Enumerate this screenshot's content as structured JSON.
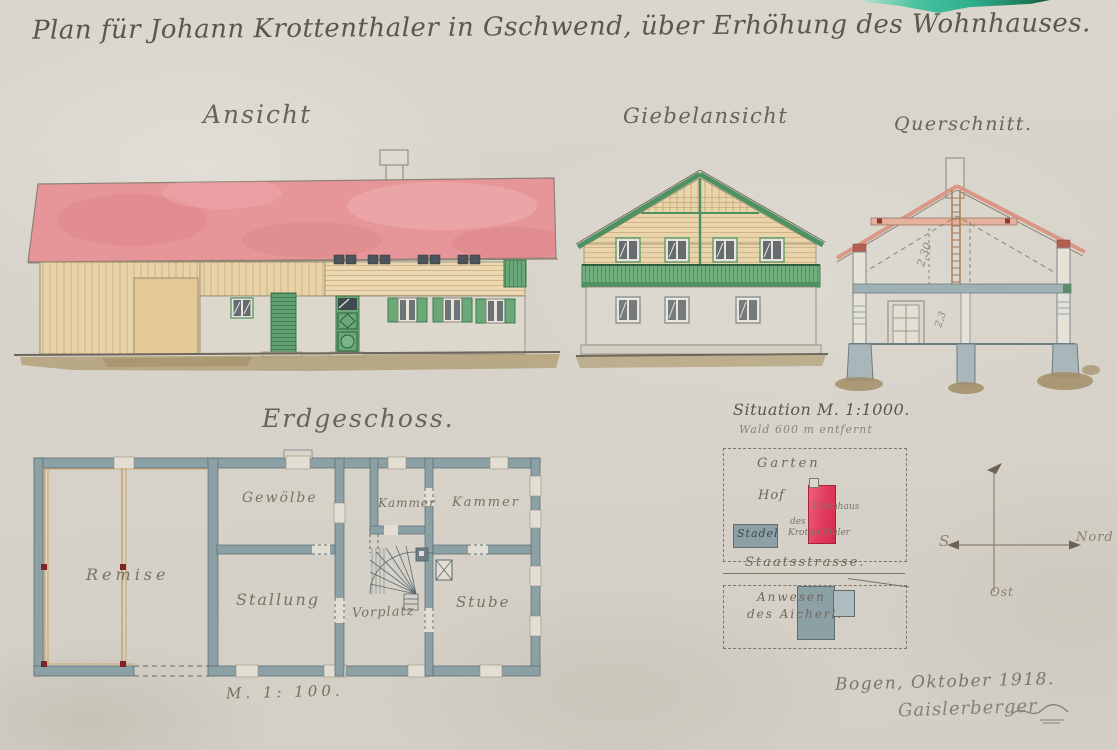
{
  "title": "Plan für Johann Krottenthaler in Gschwend, über Erhöhung des Wohnhauses.",
  "labels": {
    "ansicht": "Ansicht",
    "giebelansicht": "Giebelansicht",
    "querschnitt": "Querschnitt.",
    "erdgeschoss": "Erdgeschoss.",
    "scale_floorplan": "M. 1: 100."
  },
  "rooms": {
    "remise": "Remise",
    "gewoelbe": "Gewölbe",
    "stallung": "Stallung",
    "kammer_small": "Kammer",
    "kammer_large": "Kammer",
    "vorplatz": "Vorplatz",
    "stube": "Stube"
  },
  "cross_section": {
    "dim_upper": "2,30",
    "dim_lower": "2,3"
  },
  "situation": {
    "title": "Situation M. 1:1000.",
    "note": "Wald 600 m entfernt",
    "garten": "Garten",
    "hof": "Hof",
    "stadel": "Stadel",
    "wohnhaus": [
      "Wohnhaus",
      "des",
      "Krottenthaler"
    ],
    "strasse": "Staatsstrasse.",
    "anwesen": [
      "Anwesen",
      "des Aicherl."
    ]
  },
  "compass": {
    "sued": "S",
    "nord": "Nord",
    "ost": "Ost"
  },
  "footer": {
    "place_date": "Bogen, Oktober 1918.",
    "signature": "Gaislerberger"
  },
  "colors": {
    "paper": "#d7d3ca",
    "ink": "#655d52",
    "pencil": "#8b8379",
    "roof_pink": "#e69598",
    "wood_tan": "#e8d3a9",
    "shutter_green": "#6aa878",
    "trim_green": "#4f9160",
    "plan_wall_gray": "#8ca1a6",
    "rafter_salmon": "#d89884",
    "ground_brown": "#b19e74",
    "situation_red": "#e23a5c",
    "post_red": "#7b2329",
    "scan_teal": "#35b893"
  }
}
